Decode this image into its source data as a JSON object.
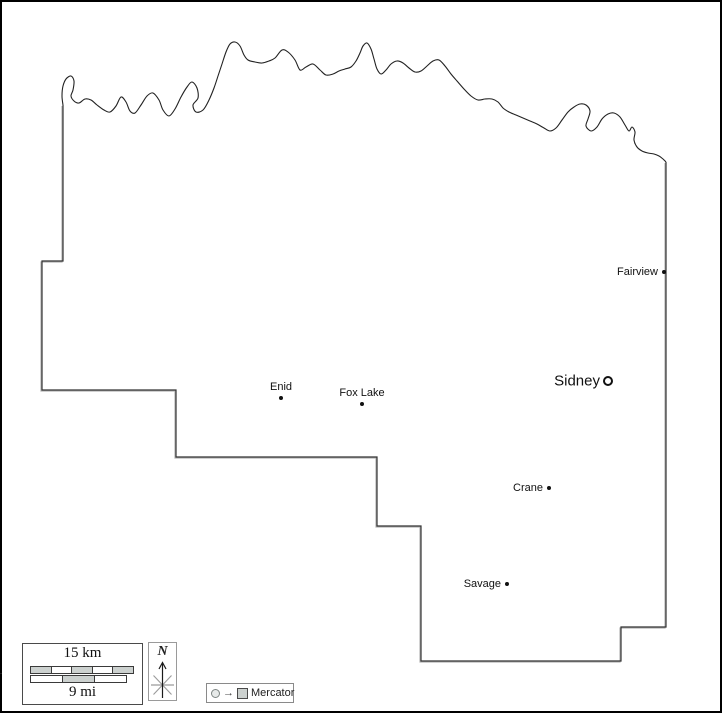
{
  "map": {
    "copyright": "© d-maps.com",
    "colors": {
      "boundary": "#333333",
      "boundary_shadow": "#b5b5b5",
      "river": "#222222",
      "label": "#111111",
      "gray_fill": "#ccd1cf",
      "background": "#ffffff",
      "frame": "#000000"
    },
    "border_points": [
      [
        63,
        105
      ],
      [
        63,
        261
      ],
      [
        42,
        261
      ],
      [
        42,
        390
      ],
      [
        176,
        390
      ],
      [
        176,
        457
      ],
      [
        377,
        457
      ],
      [
        377,
        526
      ],
      [
        421,
        526
      ],
      [
        421,
        661
      ],
      [
        621,
        661
      ],
      [
        621,
        627
      ],
      [
        666,
        627
      ],
      [
        666,
        162
      ]
    ],
    "river_points": [
      [
        63,
        105
      ],
      [
        62,
        96
      ],
      [
        63,
        86
      ],
      [
        66,
        79
      ],
      [
        71,
        76
      ],
      [
        74,
        81
      ],
      [
        73,
        90
      ],
      [
        71,
        96
      ],
      [
        74,
        101
      ],
      [
        79,
        103
      ],
      [
        85,
        99
      ],
      [
        91,
        100
      ],
      [
        97,
        105
      ],
      [
        104,
        110
      ],
      [
        110,
        112
      ],
      [
        116,
        106
      ],
      [
        121,
        97
      ],
      [
        126,
        102
      ],
      [
        130,
        111
      ],
      [
        135,
        113
      ],
      [
        141,
        105
      ],
      [
        147,
        96
      ],
      [
        153,
        93
      ],
      [
        159,
        100
      ],
      [
        163,
        110
      ],
      [
        169,
        116
      ],
      [
        175,
        109
      ],
      [
        181,
        97
      ],
      [
        187,
        87
      ],
      [
        192,
        82
      ],
      [
        197,
        88
      ],
      [
        198,
        98
      ],
      [
        193,
        105
      ],
      [
        196,
        112
      ],
      [
        203,
        110
      ],
      [
        209,
        100
      ],
      [
        214,
        88
      ],
      [
        218,
        76
      ],
      [
        222,
        64
      ],
      [
        226,
        52
      ],
      [
        230,
        44
      ],
      [
        235,
        42
      ],
      [
        240,
        46
      ],
      [
        244,
        55
      ],
      [
        248,
        60
      ],
      [
        255,
        62
      ],
      [
        262,
        63
      ],
      [
        269,
        61
      ],
      [
        275,
        58
      ],
      [
        282,
        50
      ],
      [
        288,
        52
      ],
      [
        295,
        60
      ],
      [
        300,
        70
      ],
      [
        306,
        67
      ],
      [
        313,
        64
      ],
      [
        320,
        70
      ],
      [
        326,
        75
      ],
      [
        333,
        74
      ],
      [
        339,
        71
      ],
      [
        345,
        69
      ],
      [
        351,
        67
      ],
      [
        356,
        61
      ],
      [
        360,
        53
      ],
      [
        363,
        46
      ],
      [
        367,
        43
      ],
      [
        371,
        49
      ],
      [
        374,
        59
      ],
      [
        377,
        69
      ],
      [
        381,
        74
      ],
      [
        386,
        70
      ],
      [
        391,
        64
      ],
      [
        397,
        61
      ],
      [
        403,
        63
      ],
      [
        409,
        68
      ],
      [
        415,
        72
      ],
      [
        421,
        71
      ],
      [
        427,
        66
      ],
      [
        433,
        61
      ],
      [
        439,
        60
      ],
      [
        445,
        66
      ],
      [
        451,
        74
      ],
      [
        457,
        81
      ],
      [
        464,
        89
      ],
      [
        471,
        96
      ],
      [
        478,
        100
      ],
      [
        485,
        99
      ],
      [
        492,
        99
      ],
      [
        498,
        102
      ],
      [
        503,
        108
      ],
      [
        509,
        112
      ],
      [
        516,
        115
      ],
      [
        523,
        118
      ],
      [
        530,
        121
      ],
      [
        537,
        124
      ],
      [
        544,
        128
      ],
      [
        550,
        131
      ],
      [
        556,
        128
      ],
      [
        562,
        120
      ],
      [
        568,
        112
      ],
      [
        574,
        107
      ],
      [
        580,
        104
      ],
      [
        586,
        105
      ],
      [
        590,
        111
      ],
      [
        588,
        119
      ],
      [
        586,
        126
      ],
      [
        591,
        131
      ],
      [
        597,
        127
      ],
      [
        602,
        119
      ],
      [
        608,
        114
      ],
      [
        614,
        113
      ],
      [
        620,
        117
      ],
      [
        625,
        125
      ],
      [
        629,
        131
      ],
      [
        632,
        127
      ],
      [
        635,
        132
      ],
      [
        634,
        140
      ],
      [
        637,
        147
      ],
      [
        642,
        151
      ],
      [
        648,
        153
      ],
      [
        654,
        154
      ],
      [
        659,
        156
      ],
      [
        663,
        159
      ],
      [
        666,
        162
      ]
    ],
    "cities": [
      {
        "name": "Fairview",
        "x": 664,
        "y": 272,
        "marker": "dot",
        "label_side": "left",
        "type": "town"
      },
      {
        "name": "Sidney",
        "x": 608,
        "y": 381,
        "marker": "ring",
        "label_side": "left",
        "type": "seat"
      },
      {
        "name": "Enid",
        "x": 281,
        "y": 398,
        "marker": "dot",
        "label_side": "above",
        "type": "town"
      },
      {
        "name": "Fox Lake",
        "x": 362,
        "y": 404,
        "marker": "dot",
        "label_side": "above",
        "type": "town"
      },
      {
        "name": "Crane",
        "x": 549,
        "y": 488,
        "marker": "dot",
        "label_side": "left",
        "type": "town"
      },
      {
        "name": "Savage",
        "x": 507,
        "y": 584,
        "marker": "dot",
        "label_side": "left",
        "type": "town"
      }
    ]
  },
  "scale": {
    "km_label": "15 km",
    "mi_label": "9 mi",
    "km_segments": [
      "gray",
      "white",
      "gray",
      "white",
      "gray"
    ],
    "mi_segments": [
      "white",
      "gray",
      "white"
    ]
  },
  "compass": {
    "label": "N",
    "icon": "compass-star-arrow"
  },
  "legend": {
    "projection_label": "Mercator",
    "arrow_glyph": "→",
    "icon": "circle-to-square-icon"
  }
}
